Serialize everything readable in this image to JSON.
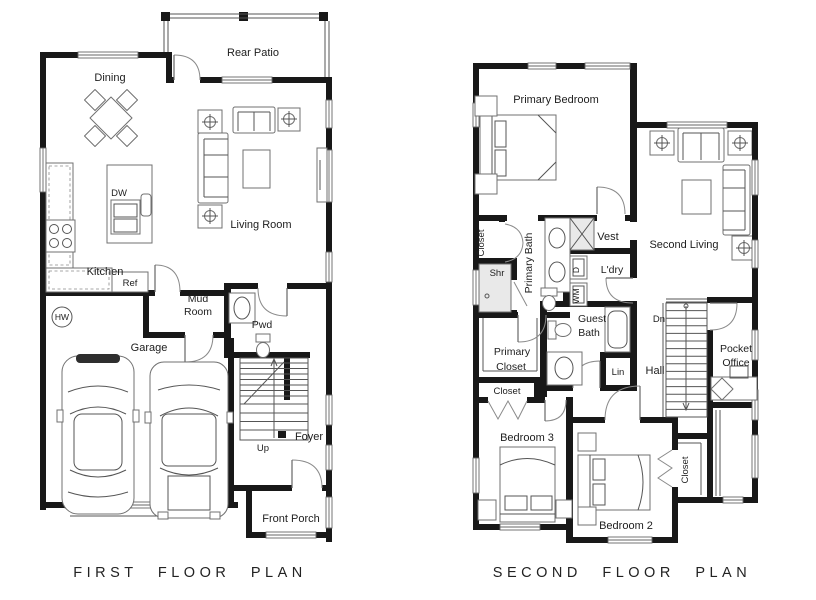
{
  "first_floor": {
    "title": "FIRST FLOOR PLAN",
    "labels": {
      "rear_patio": "Rear Patio",
      "dining": "Dining",
      "living_room": "Living Room",
      "kitchen": "Kitchen",
      "dishwasher": "DW",
      "refrigerator": "Ref",
      "mud_room_line1": "Mud",
      "mud_room_line2": "Room",
      "powder": "Pwd",
      "water_heater": "HW",
      "garage": "Garage",
      "stairs_up": "Up",
      "foyer": "Foyer",
      "front_porch": "Front Porch"
    }
  },
  "second_floor": {
    "title": "SECOND FLOOR PLAN",
    "labels": {
      "primary_bedroom": "Primary Bedroom",
      "closet_hall": "Closet",
      "shower": "Shr",
      "primary_bath": "Primary Bath",
      "vestibule": "Vest",
      "dryer": "D",
      "washer": "WM",
      "laundry": "L'dry",
      "second_living": "Second Living",
      "guest_bath_line1": "Guest",
      "guest_bath_line2": "Bath",
      "primary_closet_line1": "Primary",
      "primary_closet_line2": "Closet",
      "closet_bedroom3": "Closet",
      "linen": "Lin",
      "hall": "Hall",
      "stairs_down": "Dn",
      "pocket_office_line1": "Pocket",
      "pocket_office_line2": "Office",
      "bedroom3": "Bedroom 3",
      "bedroom2": "Bedroom 2",
      "closet_bedroom2": "Closet"
    }
  },
  "colors": {
    "wall": "#181818",
    "line": "#555555",
    "text": "#1d1d1d"
  }
}
